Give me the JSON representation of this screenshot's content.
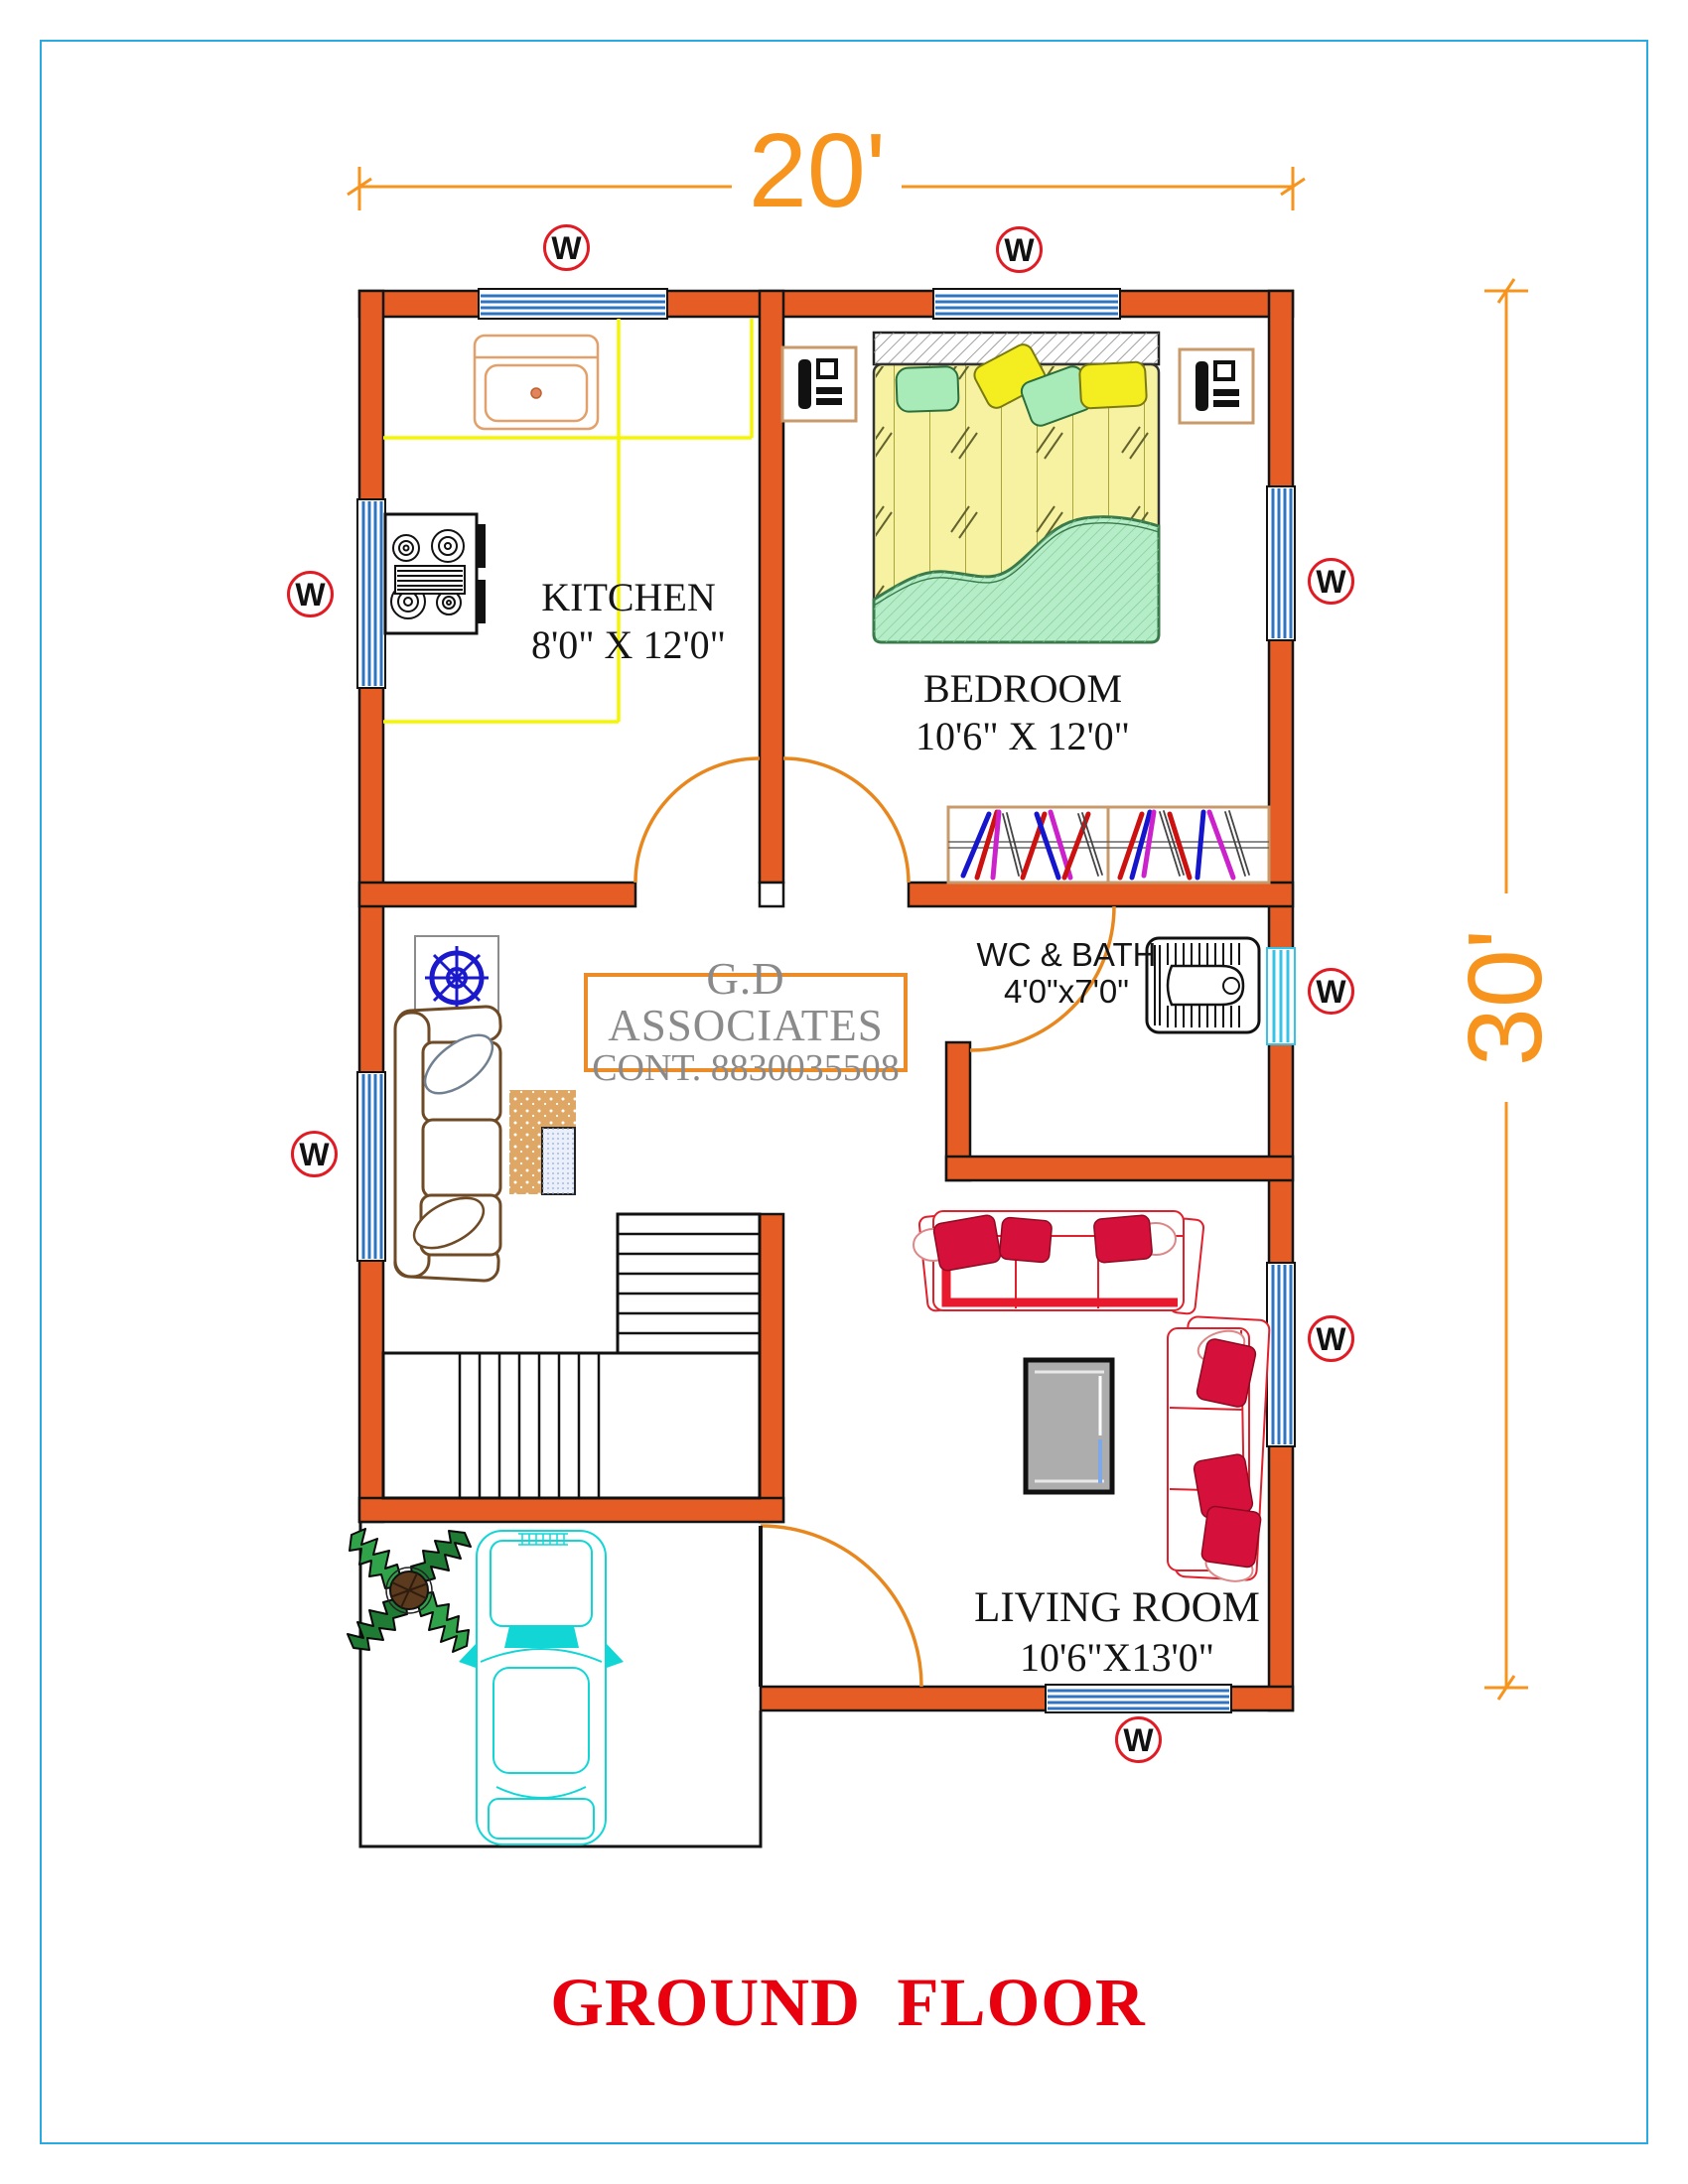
{
  "page": {
    "title": "GROUND  FLOOR"
  },
  "firm": {
    "name": "G.D ASSOCIATES",
    "contact": "CONT. 8830035508"
  },
  "dimensions": {
    "width_label": "20'",
    "depth_label": "30'"
  },
  "window_marker_label": "W",
  "rooms": {
    "kitchen": {
      "name": "KITCHEN",
      "size": "8'0\" X 12'0\""
    },
    "bedroom": {
      "name": "BEDROOM",
      "size": "10'6\" X 12'0\""
    },
    "wc_bath": {
      "name": "WC & BATH",
      "size": "4'0\"x7'0\""
    },
    "living_room": {
      "name": "LIVING ROOM",
      "size": "10'6\"X13'0\""
    }
  },
  "colors": {
    "wall": "#E55D25",
    "dimension": "#F7941E",
    "window_glass": "#2E74C0",
    "wc_window": "#35C4E8",
    "marker_ring": "#E01B24",
    "title_text": "#E8000E",
    "counter": "#F5F500",
    "firm_text": "#8A8A8A",
    "page_border": "#29ABE2"
  }
}
